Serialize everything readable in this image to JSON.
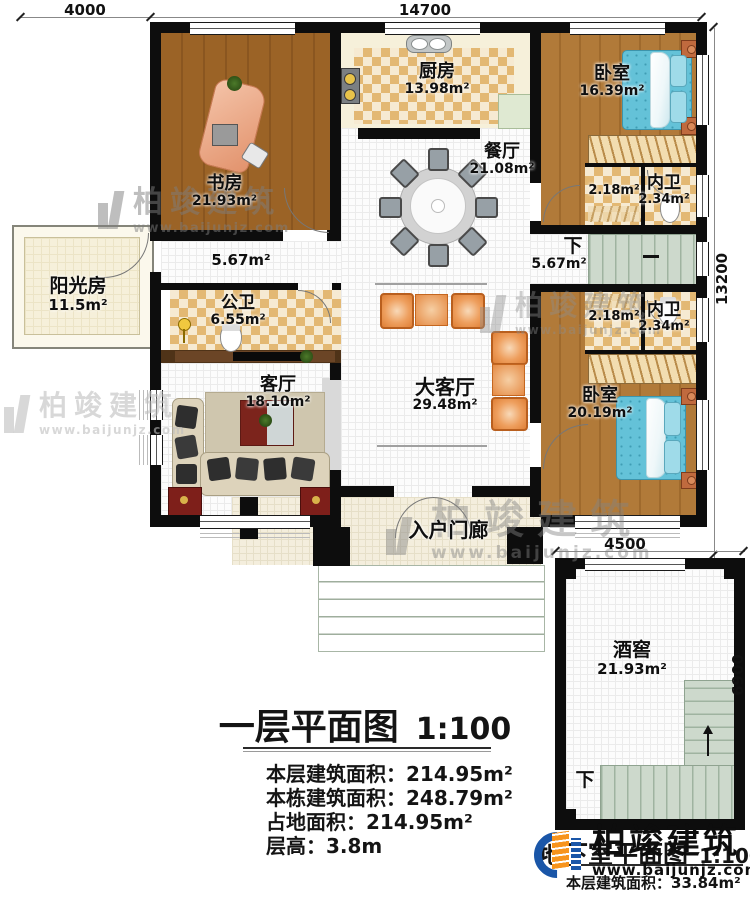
{
  "dims": {
    "d4000": "4000",
    "d14700": "14700",
    "d13200": "13200",
    "d4500": "4500",
    "d6900": "6900"
  },
  "rooms": {
    "study": {
      "name": "书房",
      "area": "21.93m²"
    },
    "kitchen": {
      "name": "厨房",
      "area": "13.98m²"
    },
    "bedroom1": {
      "name": "卧室",
      "area": "16.39m²"
    },
    "dining": {
      "name": "餐厅",
      "area": "21.08m²"
    },
    "closet1": {
      "area": "2.18m²"
    },
    "ensuite1": {
      "name": "内卫",
      "area": "2.34m²"
    },
    "stairhall": {
      "label": "下",
      "area": "5.67m²"
    },
    "hallway": {
      "area": "5.67m²"
    },
    "sunroom": {
      "name": "阳光房",
      "area": "11.5m²"
    },
    "pubbath": {
      "name": "公卫",
      "area": "6.55m²"
    },
    "living": {
      "name": "客厅",
      "area": "18.10m²"
    },
    "greathall": {
      "name": "大客厅",
      "area": "29.48m²"
    },
    "closet2": {
      "area": "2.18m²"
    },
    "ensuite2": {
      "name": "内卫",
      "area": "2.34m²"
    },
    "bedroom2": {
      "name": "卧室",
      "area": "20.19m²"
    },
    "porch": {
      "name": "入户门廊"
    },
    "cellar": {
      "name": "酒窖",
      "area": "21.93m²"
    },
    "cellar_stairs": {
      "label": "下"
    }
  },
  "title_block": {
    "title": "一层平面图",
    "scale": "1:100",
    "stats": [
      "本层建筑面积：214.95m²",
      "本栋建筑面积：248.79m²",
      "占地面积：214.95m²",
      "层高：3.8m"
    ]
  },
  "basement_block": {
    "title": "地下室平面图",
    "scale": "1:100",
    "stat": "本层建筑面积：33.84m²"
  },
  "watermark": {
    "brand": "柏竣建筑",
    "url": "www.baijunjz.com"
  },
  "colors": {
    "wall": "#0d0d0d",
    "wood_study": "#9b6326",
    "wood_bedroom": "#b17a39",
    "checker_tan": "#e3b873",
    "stair_sage": "#cdd9cc",
    "bed_blue": "#64c2d8",
    "accent_orange": "#e78840",
    "logo_blue": "#1a56a8",
    "logo_orange": "#f7941d"
  }
}
